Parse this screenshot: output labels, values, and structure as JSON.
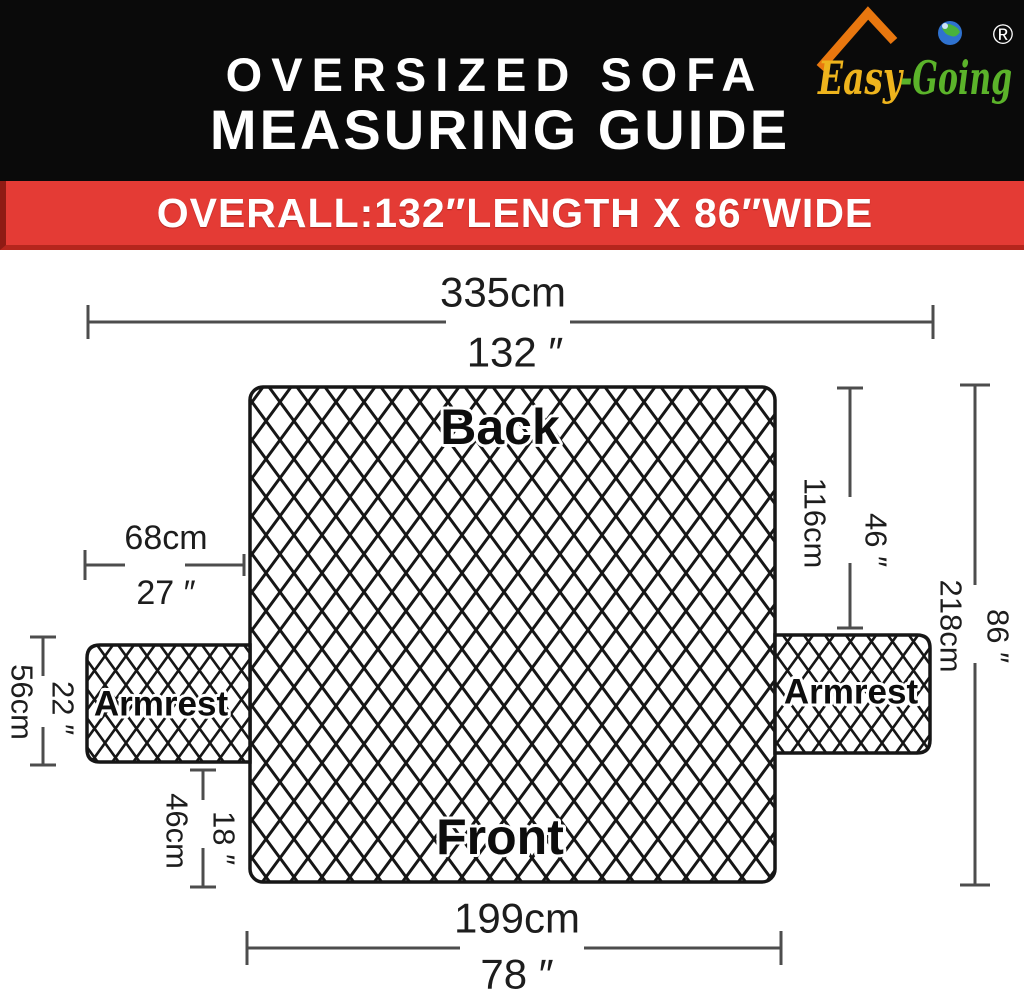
{
  "header": {
    "title_line1": "OVERSIZED SOFA",
    "title_line2": "MEASURING GUIDE",
    "logo": {
      "brand_easy": "Easy",
      "brand_going": "-Going",
      "registered": "®"
    }
  },
  "banner": {
    "text": "OVERALL:132″LENGTH X 86″WIDE"
  },
  "diagram": {
    "sections": {
      "back": "Back",
      "front": "Front",
      "armrest_left": "Armrest",
      "armrest_right": "Armrest"
    },
    "dimensions": {
      "overall_length": {
        "cm": "335cm",
        "inch": "132 ″"
      },
      "back_side_width": {
        "cm": "68cm",
        "inch": "27 ″"
      },
      "back_height": {
        "cm": "116cm",
        "inch": "46 ″"
      },
      "overall_width": {
        "cm": "218cm",
        "inch": "86 ″"
      },
      "armrest_height": {
        "cm": "56cm",
        "inch": "22 ″"
      },
      "front_skirt_height": {
        "cm": "46cm",
        "inch": "18 ″"
      },
      "front_width": {
        "cm": "199cm",
        "inch": "78 ″"
      }
    }
  },
  "colors": {
    "banner_red": "#e43b35",
    "header_black": "#0a0a0a",
    "lattice_black": "#161616",
    "dimension_line_gray": "#4d4d4d",
    "logo_orange_roof": "#e8770f",
    "logo_yellow": "#eeb41d",
    "logo_green": "#5bb32a",
    "globe_blue": "#2f72cf"
  }
}
